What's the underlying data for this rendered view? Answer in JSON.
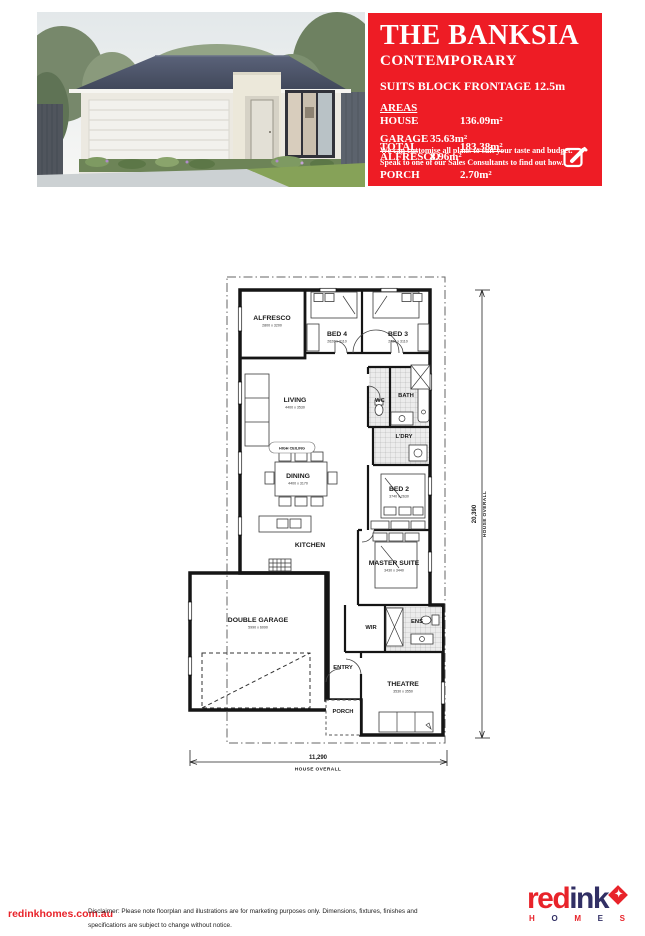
{
  "brand": {
    "red": "#e8232a",
    "navy": "#312f64",
    "logo_red": "red",
    "logo_ink": "ink",
    "star_icon": "✦",
    "homes": [
      "H",
      "O",
      "M",
      "E",
      "S"
    ]
  },
  "header": {
    "title": "THE BANKSIA",
    "subtitle": "CONTEMPORARY",
    "frontage": "SUITS BLOCK FRONTAGE  12.5m",
    "areas_heading": "AREAS",
    "areas": [
      {
        "label": "HOUSE",
        "value": "136.09m²"
      },
      {
        "label": "GARAGE",
        "value": "35.63m²"
      },
      {
        "label": "ALFRESCO",
        "value": "8.96m²"
      },
      {
        "label": "PORCH",
        "value": "2.70m²"
      }
    ],
    "total_label": "TOTAL",
    "total_value": "183.38m²",
    "customise_line1": "We can customise all plans to suit your taste and budget.",
    "customise_line2": "Speak to one of our Sales Consultants to find out how."
  },
  "plan": {
    "rooms": {
      "alfresco": {
        "label": "ALFRESCO",
        "dims": "2800 x 3200"
      },
      "bed4": {
        "label": "BED 4",
        "dims": "2620 x 3110"
      },
      "bed3": {
        "label": "BED 3",
        "dims": "2720 x 3110"
      },
      "living": {
        "label": "LIVING",
        "dims": "4400 x 3530"
      },
      "wc": {
        "label": "WC"
      },
      "bath": {
        "label": "BATH"
      },
      "ldry": {
        "label": "L'DRY"
      },
      "dining": {
        "label": "DINING",
        "dims": "4400 x 3170"
      },
      "bed2": {
        "label": "BED 2",
        "dims": "3740 x 2630"
      },
      "kitchen": {
        "label": "KITCHEN"
      },
      "master": {
        "label": "MASTER SUITE",
        "dims": "3430 x 3440"
      },
      "garage": {
        "label": "DOUBLE GARAGE",
        "dims": "5990 x 6090"
      },
      "wir": {
        "label": "WIR"
      },
      "ens": {
        "label": "ENS"
      },
      "entry": {
        "label": "ENTRY"
      },
      "theatre": {
        "label": "THEATRE",
        "dims": "3530 x 3550"
      },
      "porch": {
        "label": "PORCH"
      }
    },
    "high_ceiling": "HIGH CEILING",
    "width_dim": "11,290",
    "width_label": "HOUSE OVERALL",
    "height_dim": "20,390",
    "height_label": "HOUSE OVERALL"
  },
  "footer": {
    "url": "redinkhomes.com.au",
    "disclaimer_line1": "Disclaimer: Please note floorplan and illustrations are for marketing purposes only. Dimensions, fixtures, finishes and specifications are subject to change without notice.",
    "disclaimer_line2": "Speak to your Sales Consultant for more information on a particular design. BC12049",
    "copyright": "© Copyright 2024"
  }
}
